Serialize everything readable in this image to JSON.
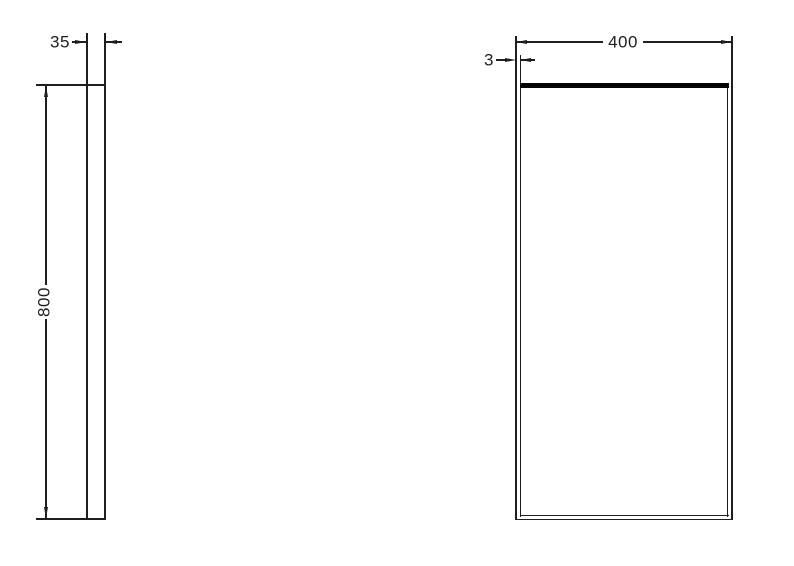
{
  "drawing": {
    "type": "technical-dimension-drawing",
    "side_view": {
      "depth_label": "35",
      "height_label": "800"
    },
    "front_view": {
      "width_label": "400",
      "edge_label": "3"
    },
    "colors": {
      "background": "#ffffff",
      "line": "#1e1e1e",
      "thick_edge": "#050505",
      "text": "#1e1e22"
    }
  }
}
